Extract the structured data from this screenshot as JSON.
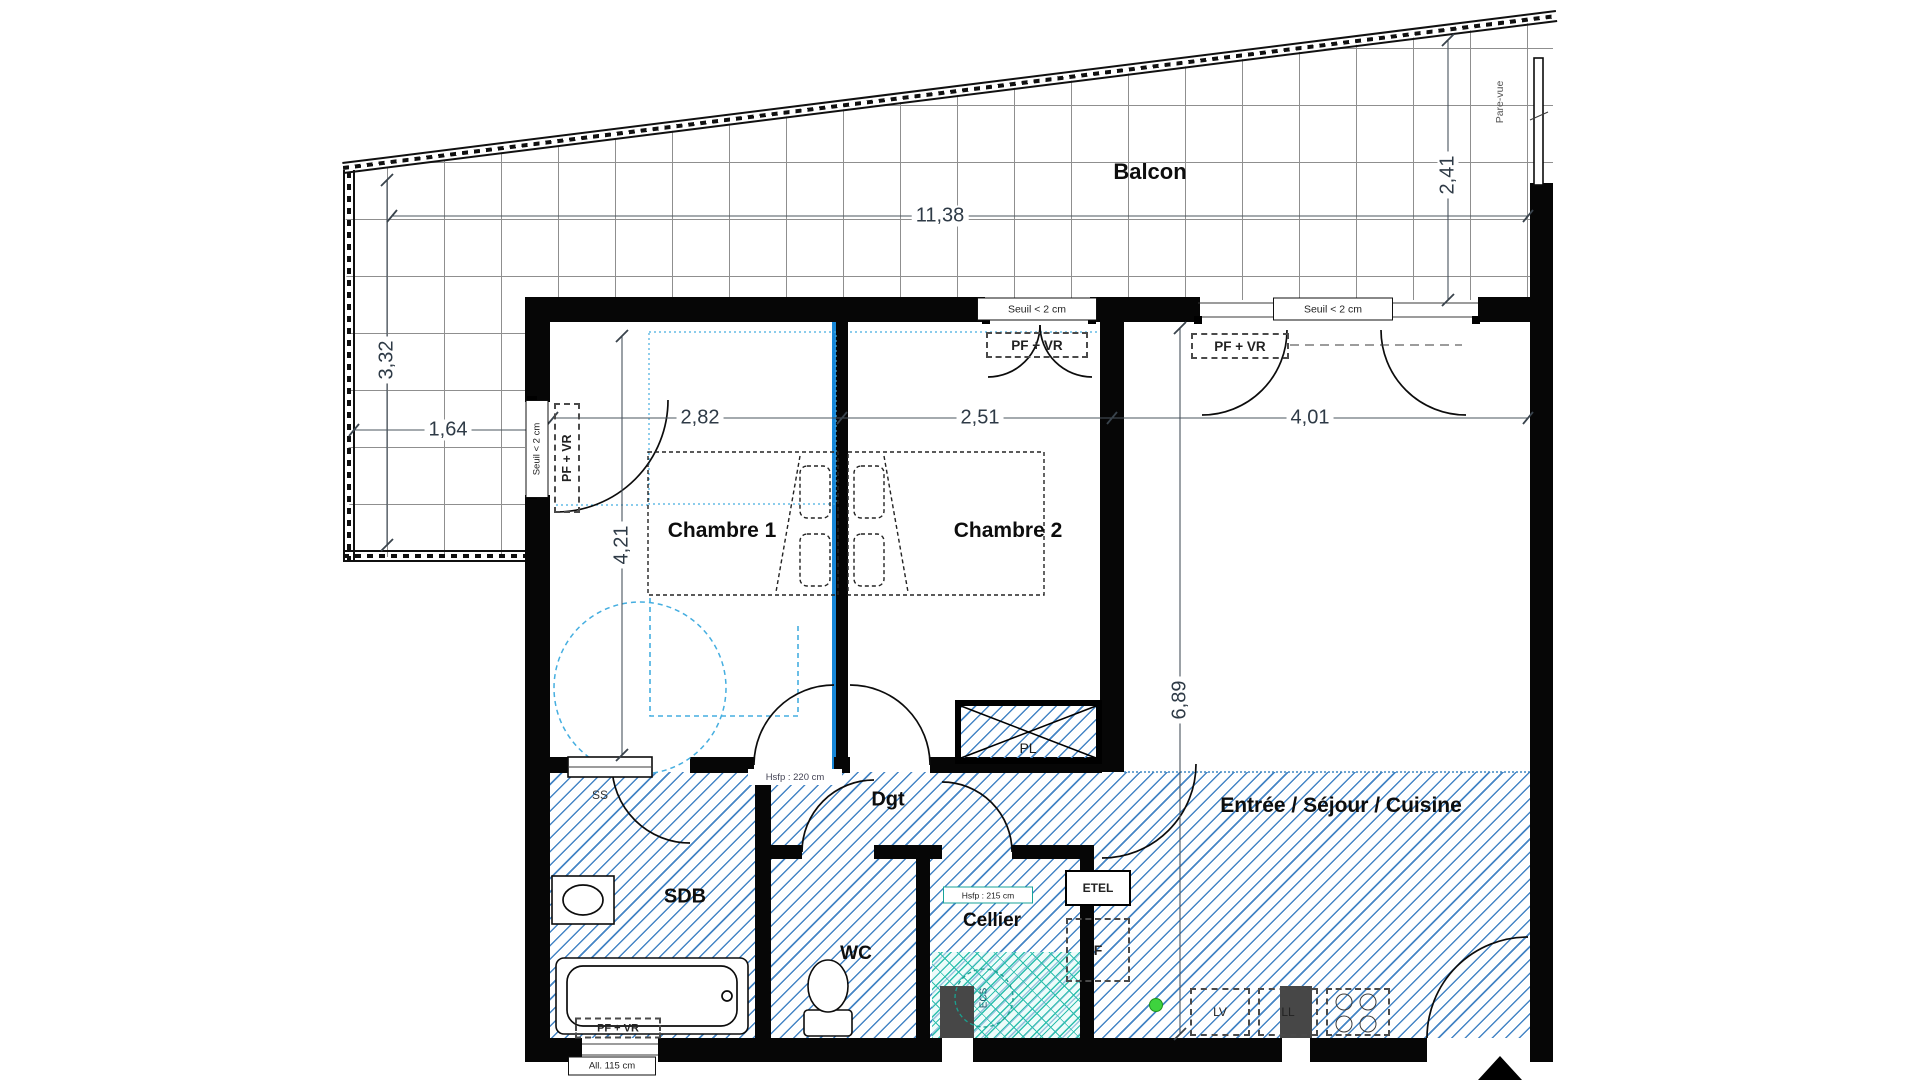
{
  "labels": {
    "balcony": "Balcon",
    "room1": "Chambre 1",
    "room2": "Chambre 2",
    "living": "Entrée / Séjour / Cuisine",
    "bathroom": "SDB",
    "wc": "WC",
    "storage": "Cellier",
    "hallway": "Dgt",
    "closet": "PL",
    "towel_rail": "SS",
    "electrical": "ETEL",
    "fridge": "F",
    "dishwasher": "LV",
    "washer": "LL",
    "water_heater": "ECS",
    "privacy_screen": "Pare-vue",
    "window_type": "PF + VR",
    "threshold": "Seuil < 2 cm",
    "sill": "All. 115 cm",
    "ceiling_h_220": "Hsfp : 220 cm",
    "ceiling_h_215": "Hsfp : 215 cm"
  },
  "dimensions": {
    "balcony_length": "11,38",
    "balcony_depth_right": "2,41",
    "balcony_depth_left": "3,32",
    "balcony_width_left": "1,64",
    "room1_width": "2,82",
    "room1_depth": "4,21",
    "room2_width": "2,51",
    "living_width": "4,01",
    "living_depth": "6,89"
  },
  "colors": {
    "wall_black": "#060606",
    "hatch_blue": "#4585c5",
    "hatch_teal": "#2fbfae",
    "accent_blue": "#45aee0",
    "divider_blue": "#1787d8",
    "marker_green": "#3ed33e"
  }
}
